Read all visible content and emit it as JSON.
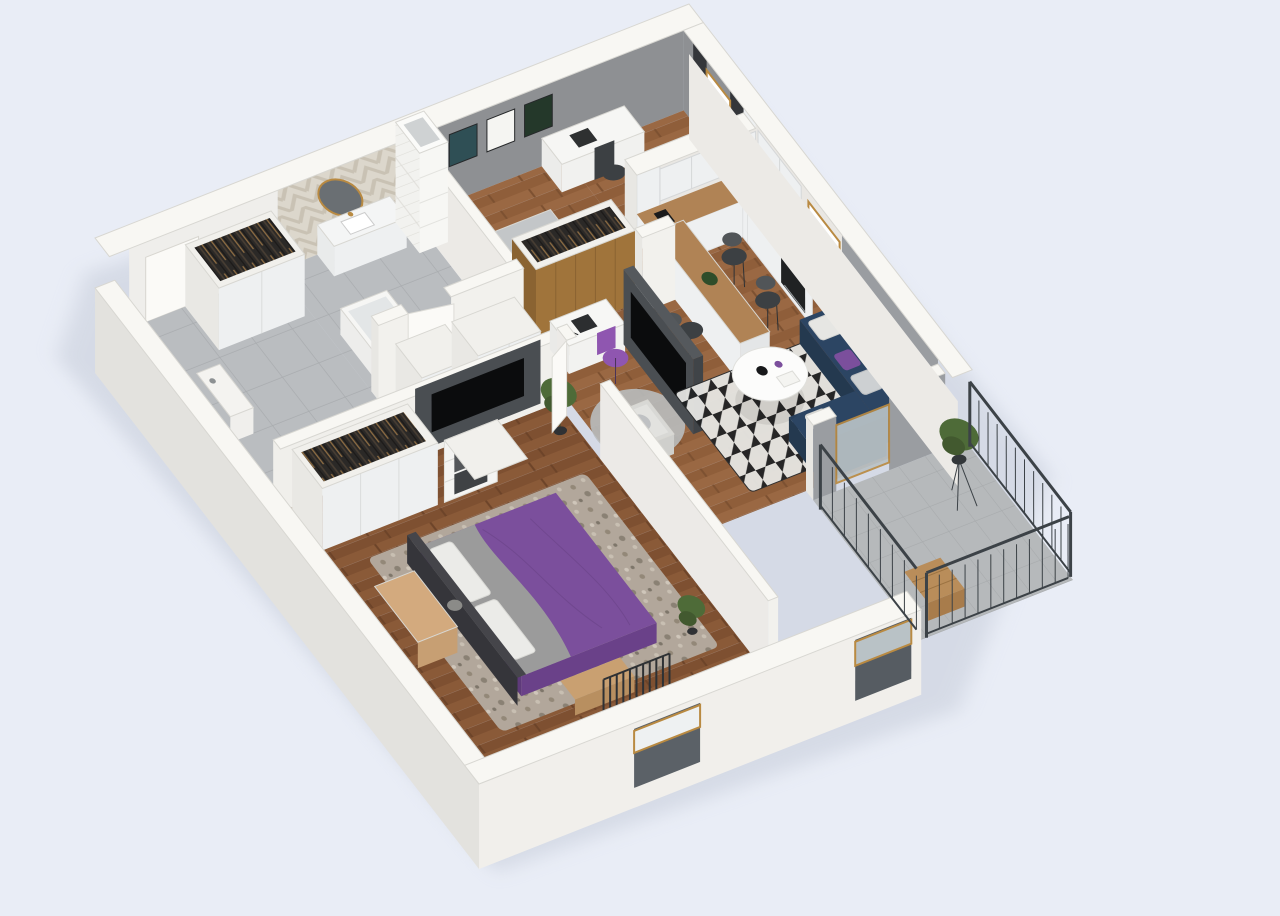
{
  "scene": {
    "type": "3d-floorplan-render",
    "description": "Isometric cutaway 3D render of a furnished one-bedroom-plus-study apartment with balcony, viewed from above at an angle. No text labels are rendered in the image.",
    "background": "#e9edf6",
    "colors": {
      "wall_top": "#f8f7f3",
      "wall_outer_left": "#e3e2de",
      "wall_outer_front": "#f1efeb",
      "wall_inner_white": "#efeeeb",
      "accent_wall_gray": "#8e9093",
      "living_wall_gray": "#9a9da1",
      "dark_feature_wall": "#4a4e52",
      "tv_screen": "#0b0c0d",
      "wood_floor": "#9c6b44",
      "wood_floor_dark": "#91603c",
      "tile_floor": "#babdc0",
      "balcony_tile": "#b6b9bb",
      "counter_wood": "#b08355",
      "cabinet_white": "#eef0f1",
      "marble": "#e9e7e3",
      "herringbone_wall": "#dcd7cc",
      "subway_tile": "#f2f2ef",
      "sofa_navy": "#2c4563",
      "sofa_navy_dark": "#24394f",
      "bed_purple": "#7b4f9c",
      "bed_purple_dark": "#6a4189",
      "blanket_gray": "#9b9b9b",
      "rug_beige": "#b2a79b",
      "railing_dark": "#3c4247",
      "frame_gold": "#b98a42",
      "curtain_dark": "#34363a",
      "wardrobe_clothes": "#2b2927",
      "plant_green": "#4e6b38",
      "chair_dark": "#3c4043",
      "chair_purple": "#8f56b0",
      "door_white": "#fbfaf7",
      "window_light": "#ffffff",
      "recess_dark": "#5b6167"
    },
    "rooms": [
      {
        "name": "entry-hall",
        "floor": "gray-tile",
        "items": [
          "entrance-door",
          "open-wardrobe-with-clothes",
          "console-table"
        ]
      },
      {
        "name": "bathroom",
        "floor": "gray-tile",
        "items": [
          "herringbone-accent-wall",
          "round-gold-mirror",
          "white-vanity-with-sink",
          "bathtub",
          "toilet",
          "tiled-duct-column"
        ]
      },
      {
        "name": "second-bedroom",
        "floor": "wood-herringbone",
        "items": [
          "gray-accent-wall",
          "three-framed-posters",
          "desk-with-chair",
          "single-bed",
          "open-wardrobe-with-clothes",
          "curtained-window"
        ]
      },
      {
        "name": "kitchen",
        "floor": "wood-herringbone",
        "items": [
          "l-shaped-wood-counter",
          "sink-with-brass-faucet",
          "built-in-oven",
          "cooktop",
          "upper-cabinets",
          "marble-backsplash",
          "breakfast-peninsula",
          "four-bar-chairs",
          "window",
          "coffee-maker"
        ]
      },
      {
        "name": "living-room",
        "floor": "wood-herringbone",
        "items": [
          "navy-corner-sofa",
          "white-round-coffee-table",
          "black-white-patterned-rug",
          "dark-tv-partition",
          "desk-nook-with-purple-chair",
          "gray-armchair",
          "round-gray-rug",
          "balcony-glass-door"
        ]
      },
      {
        "name": "master-bedroom",
        "floor": "wood-herringbone",
        "items": [
          "purple-double-bed",
          "gray-throw-blanket",
          "mottled-rug",
          "wardrobe-with-clothes",
          "shelving-with-boxes",
          "wood-vanity-desk",
          "dark-tv-wall",
          "radiator",
          "window-with-gold-frame",
          "plants",
          "bed-end-bench"
        ]
      },
      {
        "name": "balcony",
        "floor": "concrete-tile",
        "items": [
          "dark-metal-railing",
          "plant-on-stand",
          "wooden-bench"
        ]
      },
      {
        "name": "corridor",
        "floor": "wood-herringbone",
        "items": [
          "built-in-closets"
        ]
      }
    ]
  }
}
